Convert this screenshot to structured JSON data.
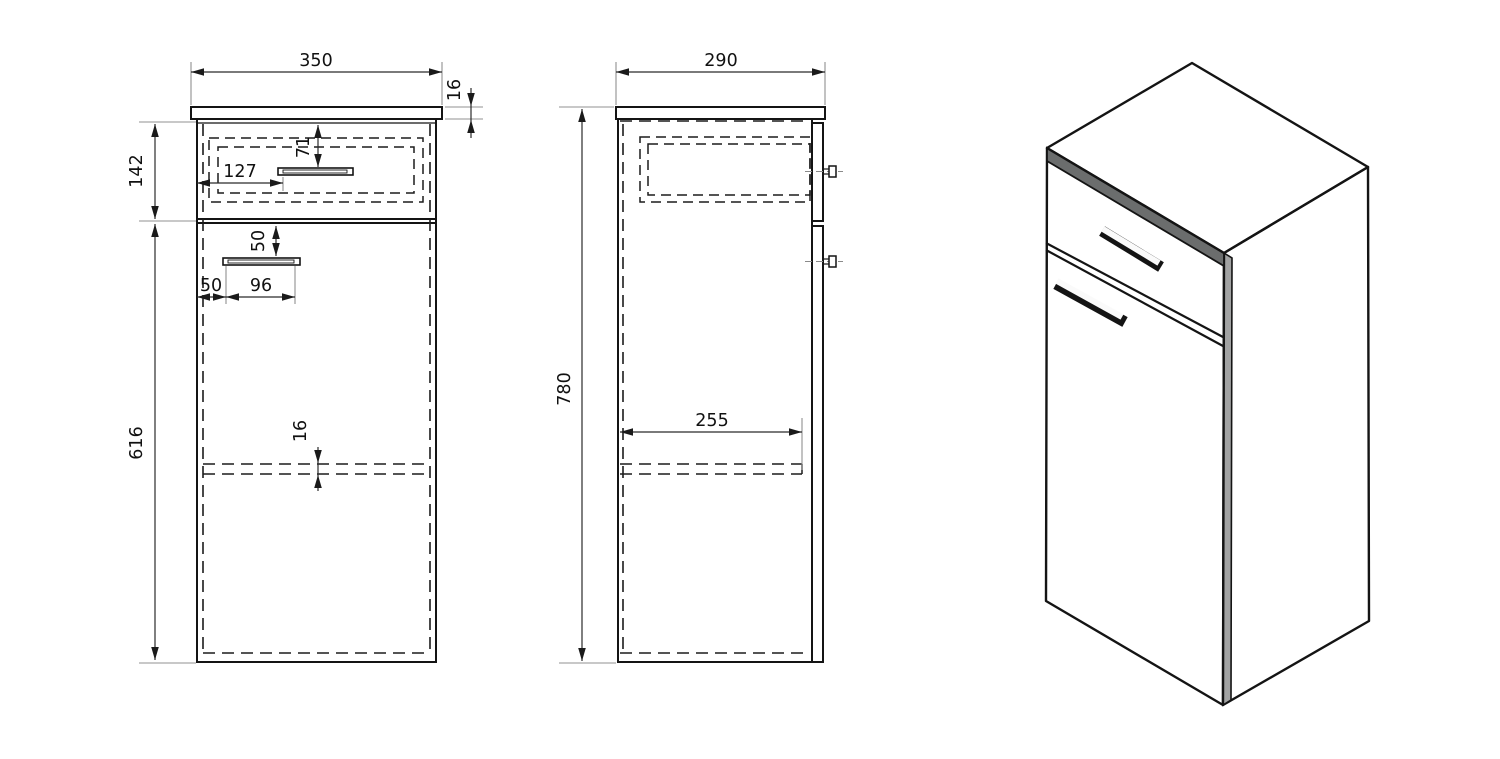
{
  "front_view": {
    "dims": {
      "overall_width": "350",
      "countertop_thickness": "16",
      "drawer_front_height": "142",
      "drawer_handle_from_top": "71",
      "drawer_handle_from_left": "127",
      "door_handle_from_divider": "50",
      "door_handle_from_left": "50",
      "door_handle_length": "96",
      "shelf_thickness": "16",
      "door_section_height": "616"
    }
  },
  "side_view": {
    "dims": {
      "overall_depth": "290",
      "overall_height": "780",
      "shelf_depth": "255"
    }
  },
  "colors": {
    "background": "#ffffff",
    "outline": "#141414",
    "dashed_line": "#1c1c1c",
    "dimension_line": "#2b2b2b",
    "extension_line": "#909090",
    "dimension_text": "#111111",
    "iso_top_face": "#d3d4d4",
    "iso_side_face": "#abadad",
    "iso_front_face": "#5b5d5d",
    "iso_countertop_edge": "#6b6d6d",
    "iso_corner_strip": "#a2a3a3",
    "handle_chrome": "#fafafa"
  }
}
